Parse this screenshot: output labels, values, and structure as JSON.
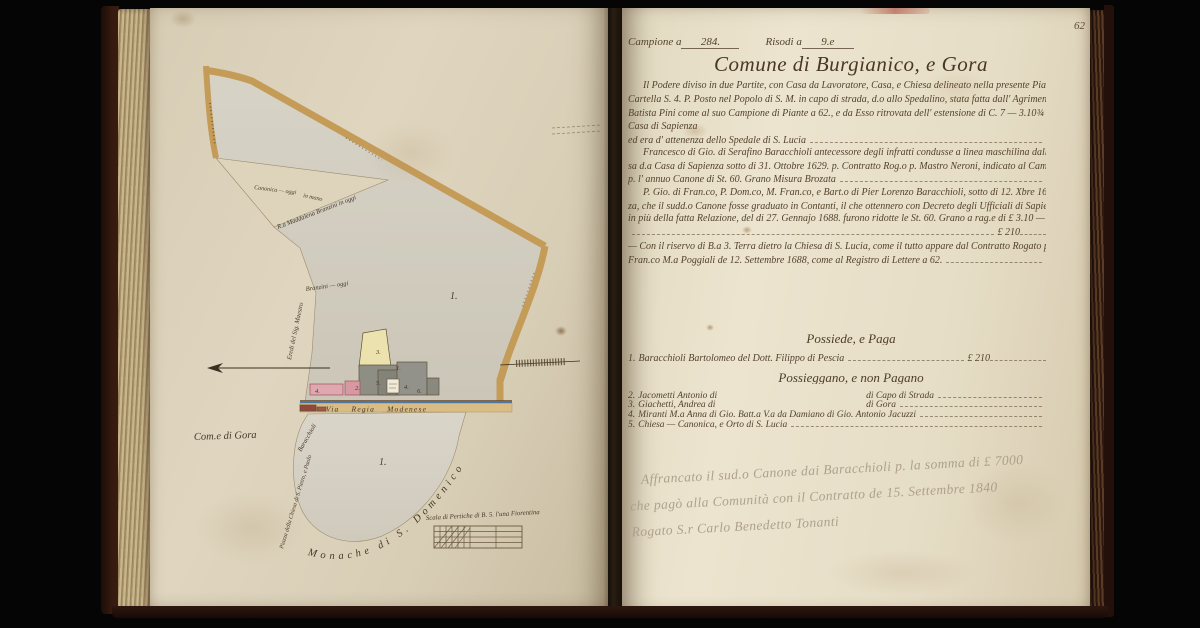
{
  "palette": {
    "page_left": "#dcd2ba",
    "page_right": "#e7dfc9",
    "ink": "#54422c",
    "pencil": "#ab9d8a",
    "road_tan": "#c59b58",
    "water_blue": "#4a76a8",
    "building_gray": "#8f8e84",
    "building_cream": "#ece2ae",
    "building_pink": "#dfa7af",
    "leather": "#3a1d12"
  },
  "book": {
    "left_page": {
      "map": {
        "upper_parcel_label": "1.",
        "lower_parcel_label": "1.",
        "road_label": "Via Regia Modenese",
        "comune_label": "Com.e di Gora",
        "monache_label": "Monache di S. Domenico",
        "scale_label": "Scala di Pertiche di B. 5. l'una Fiorentina",
        "boundary": {
          "canonica": "Canonica — oggi",
          "in_mano": "in mano",
          "maddalena": "R.a Maddalena Branzini in oggi",
          "branzini": "Branzini — oggi",
          "eredi": "Eredi del Sig. Maestro",
          "piazza": "Piazza della Chiesa di S. Pietro, e Paolo",
          "baracchioli": "Baracchioli"
        },
        "buildings": {
          "tower": "3.",
          "n1": "1.",
          "n5": "5.",
          "n4": "4.",
          "n6": "6.",
          "n2": "2.",
          "n4b": "4."
        }
      }
    },
    "right_page": {
      "page_number": "62",
      "campione_label": "Campione a",
      "campione_value": "284.",
      "risodi_label": "Risodi a",
      "risodi_value": "9.e",
      "title": "Comune di Burgianico, e Gora",
      "para1": [
        "Il Podere diviso in due Partite, con Casa da Lavoratore, Casa, e Chiesa delineato nella presente Pianta, con",
        "Cartella S. 4. P. Posto nel Popolo di S. M. in capo di strada, d.o allo Spedalino, stata fatta dall' Agrimensore Gio.",
        "Batista Pini come al suo Campione di Piante a 62., e da Esso ritrovata dell' estensione di C. 7 — 3.10¾ — Venne alla d.a",
        "Casa di Sapienza",
        "ed era d' attenenza dello Spedale di S. Lucia"
      ],
      "para2": [
        "Francesco di Gio. di Serafino Baracchioli antecessore degli infratti condusse a linea maschilina dalla sopres-",
        "sa d.a Casa di Sapienza sotto di 31. Ottobre 1629. p. Contratto Rog.o p. Mastro Neroni, indicato al Camp.e Moderno a 262.",
        "p. l' annuo Canone di St. 60. Grano Misura Brozata"
      ],
      "para3": [
        "P. Gio. di Fran.co, P. Dom.co, M. Fran.co, e Bart.o di Pier Lorenzo Baracchioli, sotto di 12. Xbre 1687. fecero istan-",
        "za, che il sudd.o Canone fosse graduato in Contanti, il che ottennero con Decreto degli Ufficiali di Sapienza registrato",
        "in più della fatta Relazione, del di 27. Gennajo 1688. furono ridotte le St. 60. Grano a rag.e di £ 3.10 — lo che annualmente a"
      ],
      "amount1": "£ 210",
      "para4": [
        "— Con il riservo di B.a 3. Terra dietro la Chiesa di S. Lucia, come il tutto appare dal Contratto Rogato p. S.r",
        "Fran.co M.a Poggiali de 12. Settembre 1688, come al Registro di Lettere a 62."
      ],
      "possiede_heading": "Possiede, e Paga",
      "possiede_row": {
        "num": "1.",
        "name": "Baracchioli Bartolomeo del Dott. Filippo di Pescia",
        "amount": "£ 210"
      },
      "possieggano_heading": "Possieggano, e non Pagano",
      "rows": [
        {
          "num": "2.",
          "name": "Jacometti Antonio di",
          "place": "di Capo di Strada"
        },
        {
          "num": "3.",
          "name": "Giachetti, Andrea di",
          "place": "di Gora"
        },
        {
          "num": "4.",
          "name": "Miranti M.a Anna di Gio. Batt.a V.a da Damiano di Gio. Antonio Jacuzzi"
        },
        {
          "num": "5.",
          "name": "Chiesa — Canonica, e Orto di S. Lucia"
        }
      ],
      "pencil_note": [
        "Affrancato il sud.o Canone dai Baracchioli p. la somma di £ 7000",
        "che pagò alla Comunità con il Contratto de 15. Settembre 1840",
        "Rogato S.r Carlo Benedetto Tonanti"
      ]
    }
  }
}
